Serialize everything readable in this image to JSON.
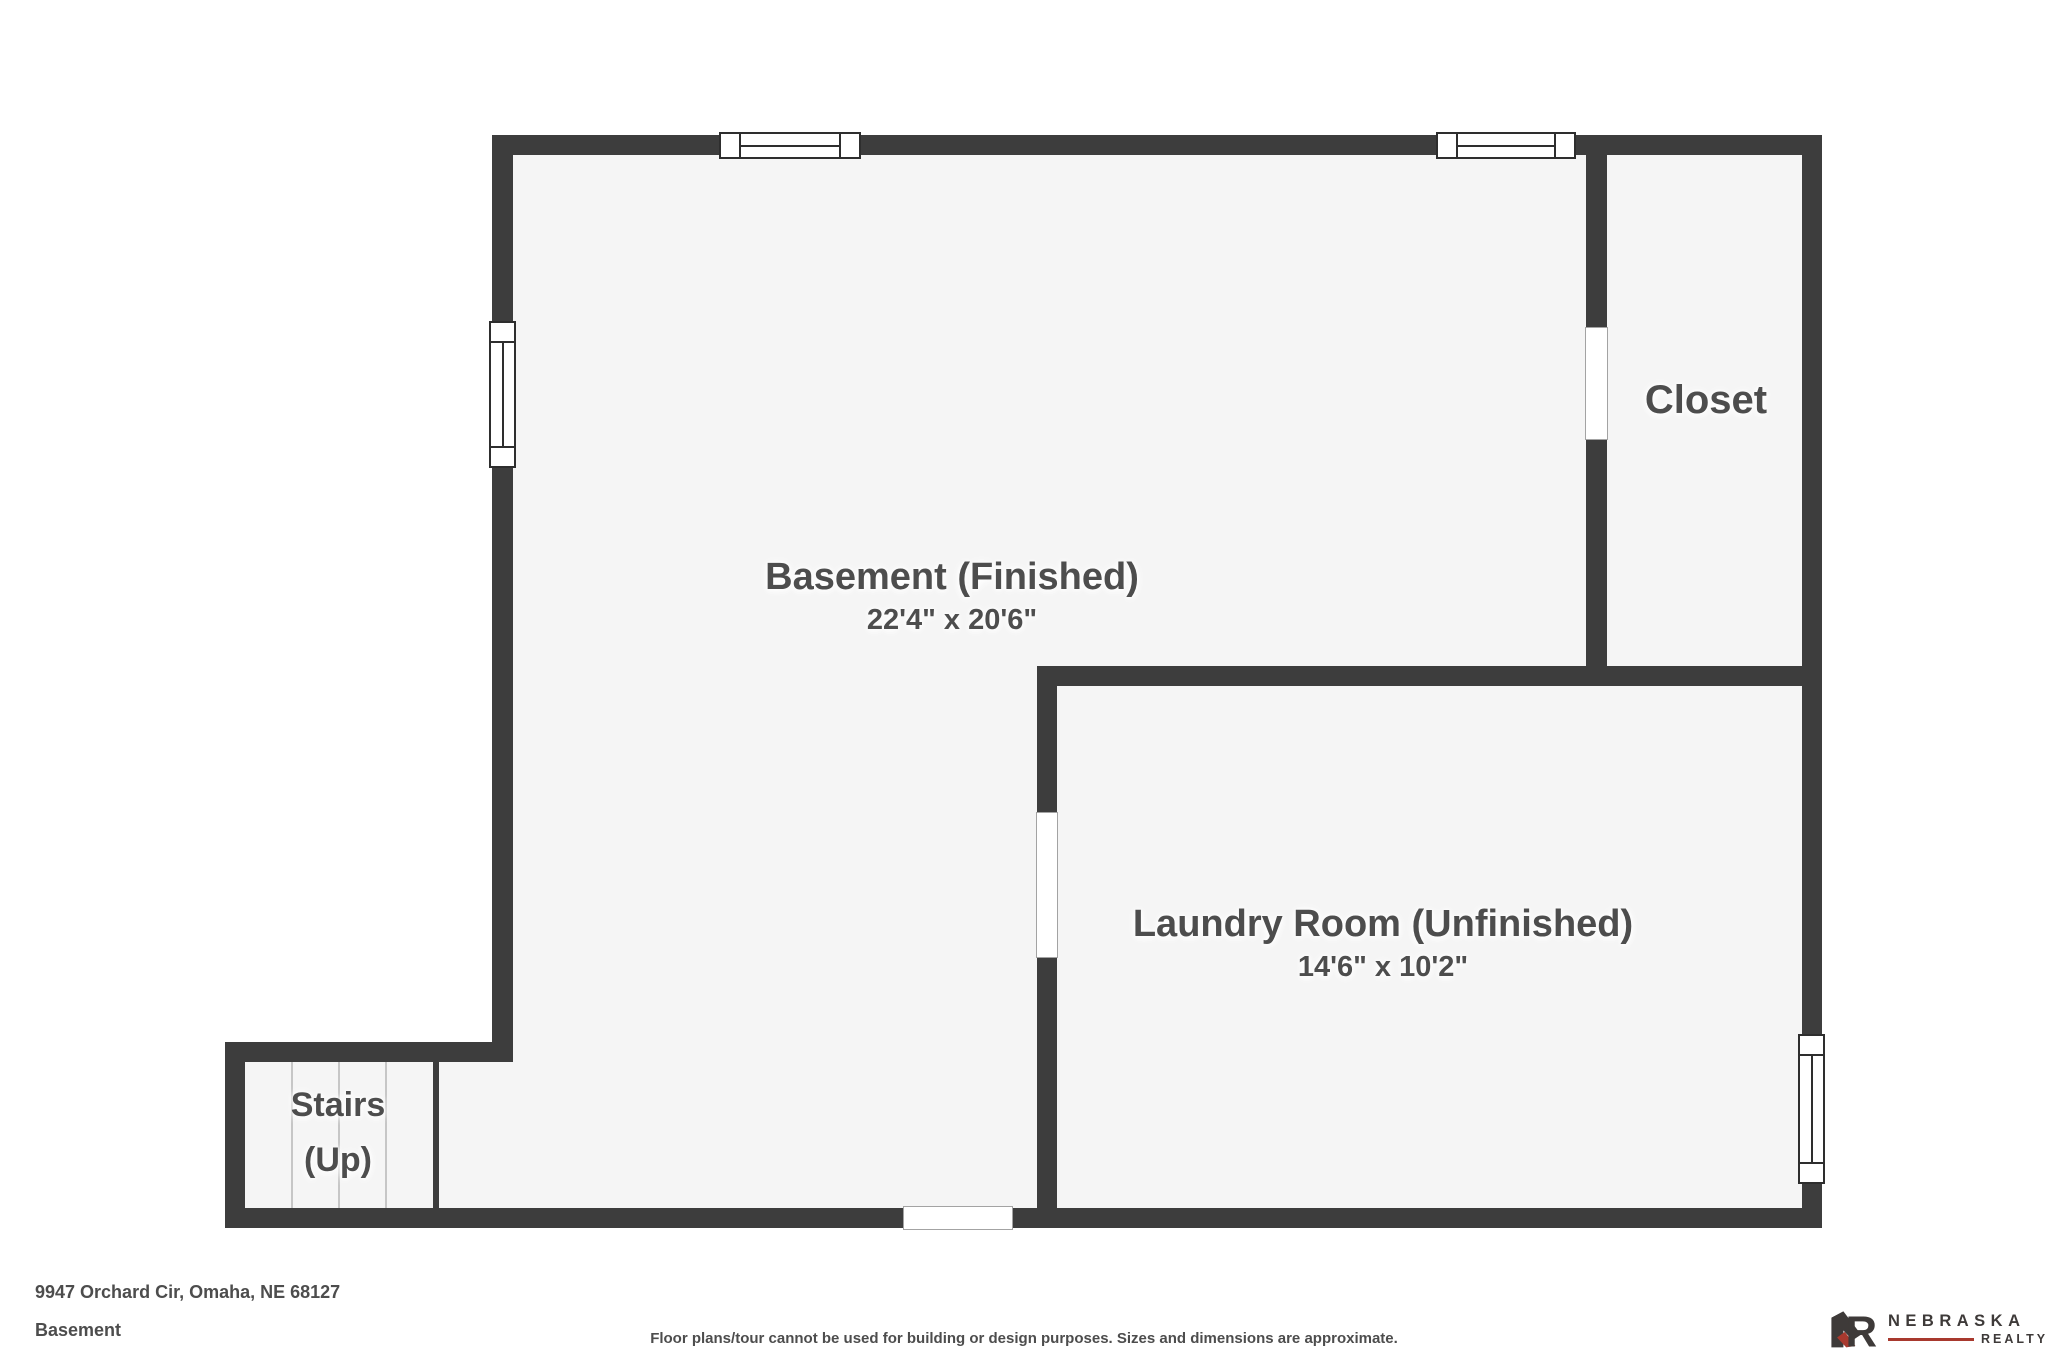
{
  "colors": {
    "background": "#ffffff",
    "wall": "#3d3d3d",
    "floor": "#f5f5f5",
    "label-text": "#4d4d4d",
    "tread-line": "#c6c6c6",
    "window-outline": "#2e2e2e",
    "door-outline": "#a3a3a3",
    "logo-accent": "#a8392e",
    "logo-text": "#3e3a39"
  },
  "rooms": {
    "basement": {
      "label": "Basement (Finished)",
      "dims": "22'4\" x 20'6\""
    },
    "laundry": {
      "label": "Laundry Room (Unfinished)",
      "dims": "14'6\" x 10'2\""
    },
    "closet": {
      "label": "Closet"
    },
    "stairs": {
      "label": "Stairs",
      "sublabel": "(Up)"
    }
  },
  "footer": {
    "address": "9947 Orchard Cir, Omaha, NE 68127",
    "floor_name": "Basement",
    "disclaimer": "Floor plans/tour cannot be used for building or design purposes. Sizes and dimensions are approximate."
  },
  "logo": {
    "monogram": "NR",
    "monogram_r": "R",
    "brand_top": "NEBRASKA",
    "brand_bottom": "REALTY"
  }
}
